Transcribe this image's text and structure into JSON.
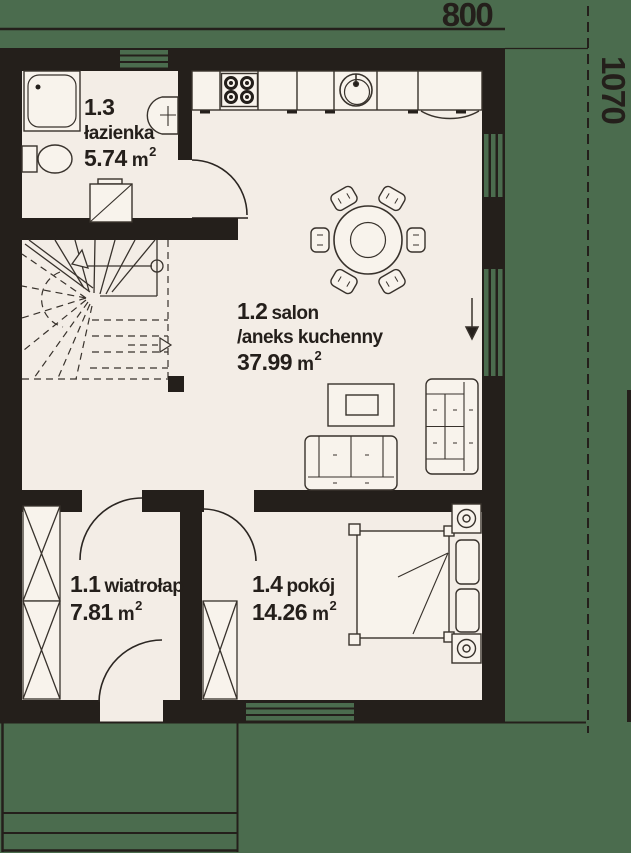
{
  "dimensions": {
    "top": "800",
    "right": "1070"
  },
  "rooms": [
    {
      "number": "1.1",
      "name": "wiatrołap",
      "area": "7.81",
      "unit": "m",
      "sup": "2"
    },
    {
      "number": "1.2",
      "name": "salon",
      "name_line2": "/aneks kuchenny",
      "area": "37.99",
      "unit": "m",
      "sup": "2"
    },
    {
      "number": "1.3",
      "name": "łazienka",
      "area": "5.74",
      "unit": "m",
      "sup": "2"
    },
    {
      "number": "1.4",
      "name": "pokój",
      "area": "14.26",
      "unit": "m",
      "sup": "2"
    }
  ],
  "colors": {
    "wall": "#241f1b",
    "floor": "#f3ede6",
    "garden": "#4b6c4e",
    "furniture_fill": "#f8f3ec",
    "outline": "#38322c"
  }
}
